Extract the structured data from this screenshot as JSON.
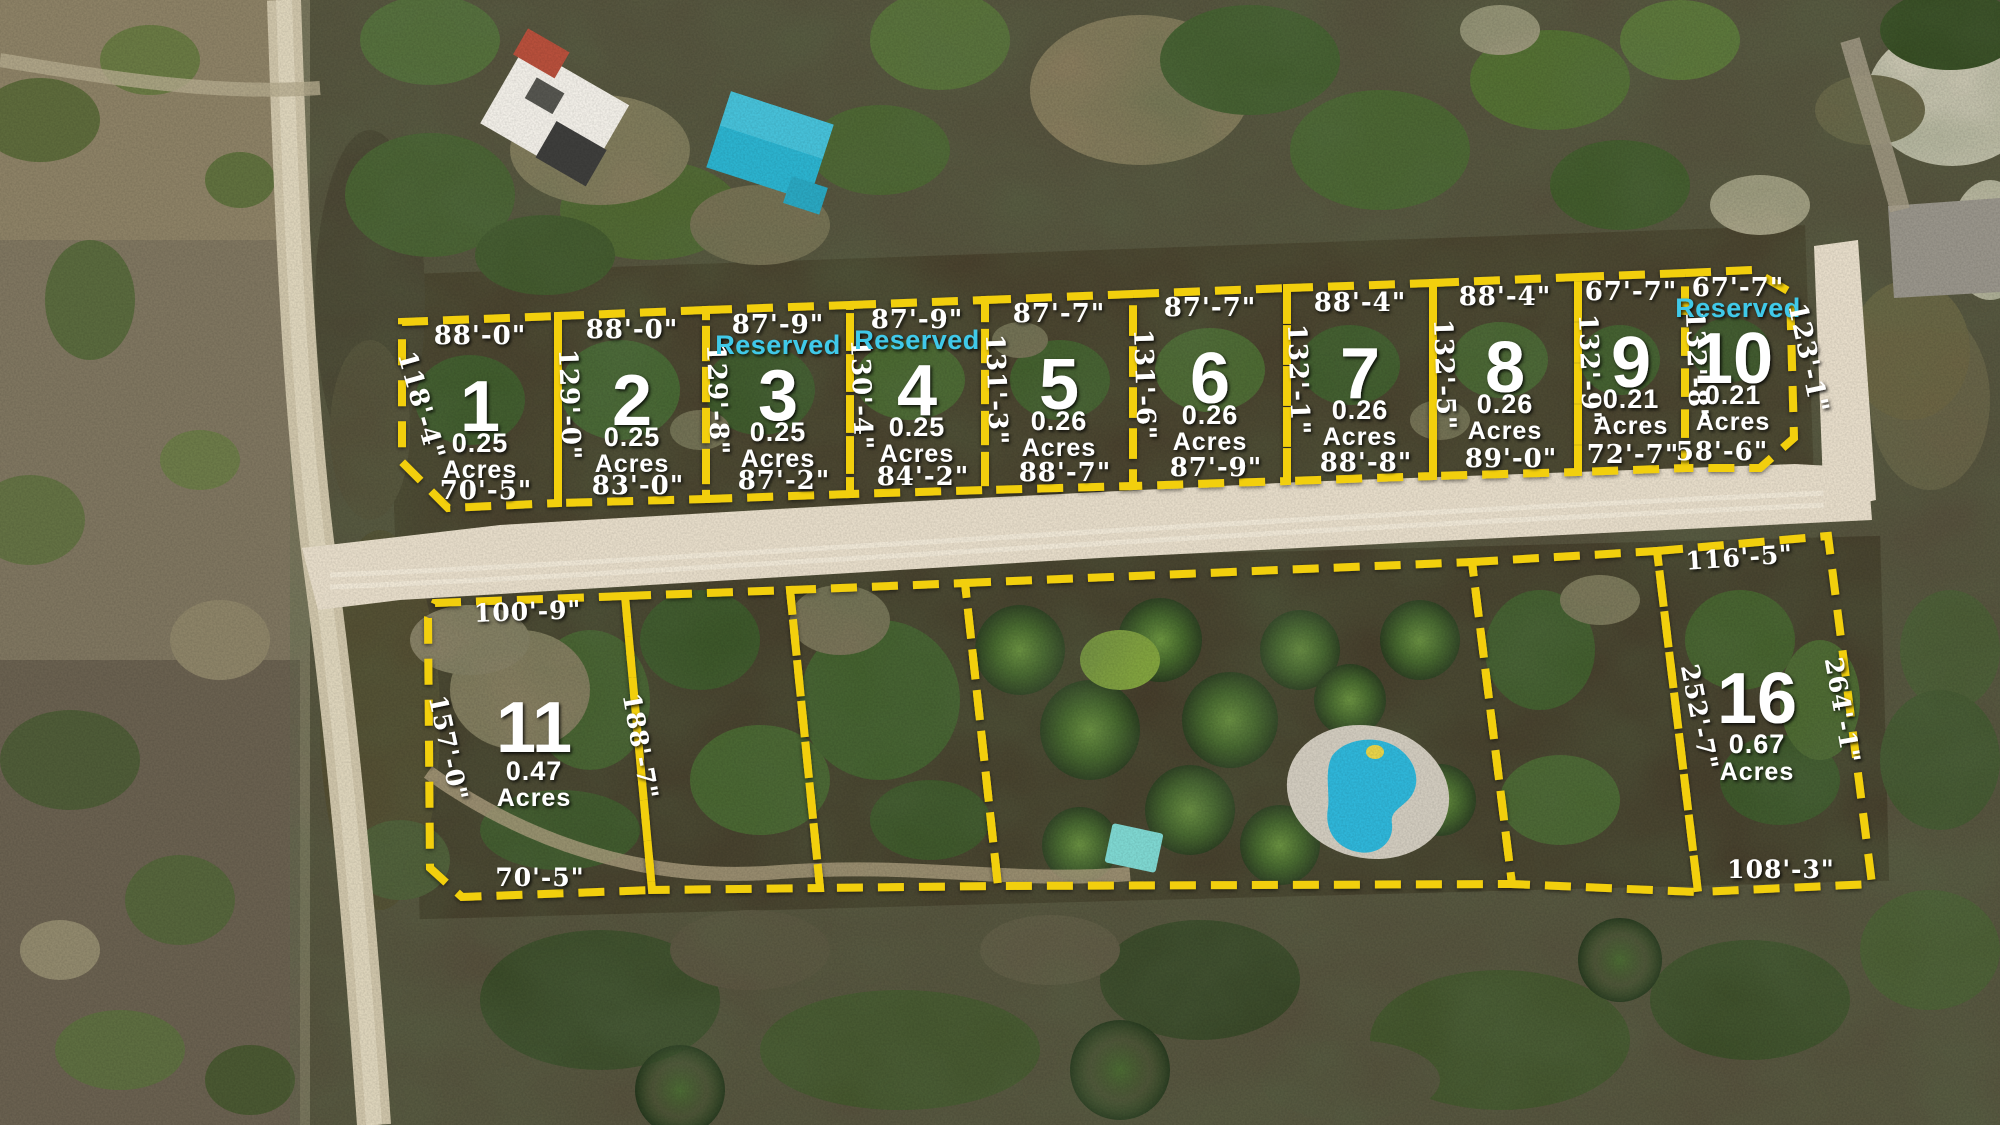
{
  "scene": {
    "type": "aerial-drone-photo",
    "description": "Subdivision plat overlay on aerial drone photo with numbered lots, acreage and boundary dimensions"
  },
  "colors": {
    "lot_line": "#f2cf0c",
    "label_text": "#ffffff",
    "reserved_text": "#3fc9e9",
    "road_sand": "#e7ddca",
    "road_dirt": "#cfc5aa",
    "pavement": "#99958b",
    "pool_water": "#2fb7da",
    "pool_deck": "#d2ccbf",
    "shed_roof": "#7fd8d2",
    "house_roof_white": "#f2efe8",
    "house_roof_turquoise": "#2cb4d0"
  },
  "lots": [
    {
      "number": "1",
      "acres": "0.25",
      "unit": "Acres",
      "dim_top": "88'-0\"",
      "dim_bottom": "70'-5\"",
      "dim_left": "118'-4\"",
      "dim_right": "129'-0\""
    },
    {
      "number": "2",
      "acres": "0.25",
      "unit": "Acres",
      "dim_top": "88'-0\"",
      "dim_bottom": "83'-0\"",
      "dim_right": "129'-8\""
    },
    {
      "number": "3",
      "acres": "0.25",
      "unit": "Acres",
      "reserved": "Reserved",
      "dim_top": "87'-9\"",
      "dim_bottom": "87'-2\"",
      "dim_right": "130'-4\""
    },
    {
      "number": "4",
      "acres": "0.25",
      "unit": "Acres",
      "reserved": "Reserved",
      "dim_top": "87'-9\"",
      "dim_bottom": "84'-2\"",
      "dim_right": "131'-3\""
    },
    {
      "number": "5",
      "acres": "0.26",
      "unit": "Acres",
      "dim_top": "87'-7\"",
      "dim_bottom": "88'-7\"",
      "dim_right": "131'-6\""
    },
    {
      "number": "6",
      "acres": "0.26",
      "unit": "Acres",
      "dim_top": "87'-7\"",
      "dim_bottom": "87'-9\"",
      "dim_right": "132'-1\""
    },
    {
      "number": "7",
      "acres": "0.26",
      "unit": "Acres",
      "dim_top": "88'-4\"",
      "dim_bottom": "88'-8\"",
      "dim_right": "132'-5\""
    },
    {
      "number": "8",
      "acres": "0.26",
      "unit": "Acres",
      "dim_top": "88'-4\"",
      "dim_bottom": "89'-0\"",
      "dim_right": "132'-9\""
    },
    {
      "number": "9",
      "acres": "0.21",
      "unit": "Acres",
      "dim_top": "67'-7\"",
      "dim_bottom": "72'-7\"",
      "dim_right": "132'-8\""
    },
    {
      "number": "10",
      "acres": "0.21",
      "unit": "Acres",
      "reserved": "Reserved",
      "dim_top": "67'-7\"",
      "dim_bottom": "58'-6\"",
      "dim_right": "123'-1\""
    },
    {
      "number": "11",
      "acres": "0.47",
      "unit": "Acres",
      "dim_top": "100'-9\"",
      "dim_bottom": "70'-5\"",
      "dim_left": "157'-0\"",
      "dim_right": "188'-7\""
    },
    {
      "number": "16",
      "acres": "0.67",
      "unit": "Acres",
      "dim_top": "116'-5\"",
      "dim_bottom": "108'-3\"",
      "dim_left": "252'-7\"",
      "dim_right": "264'-1\""
    }
  ]
}
